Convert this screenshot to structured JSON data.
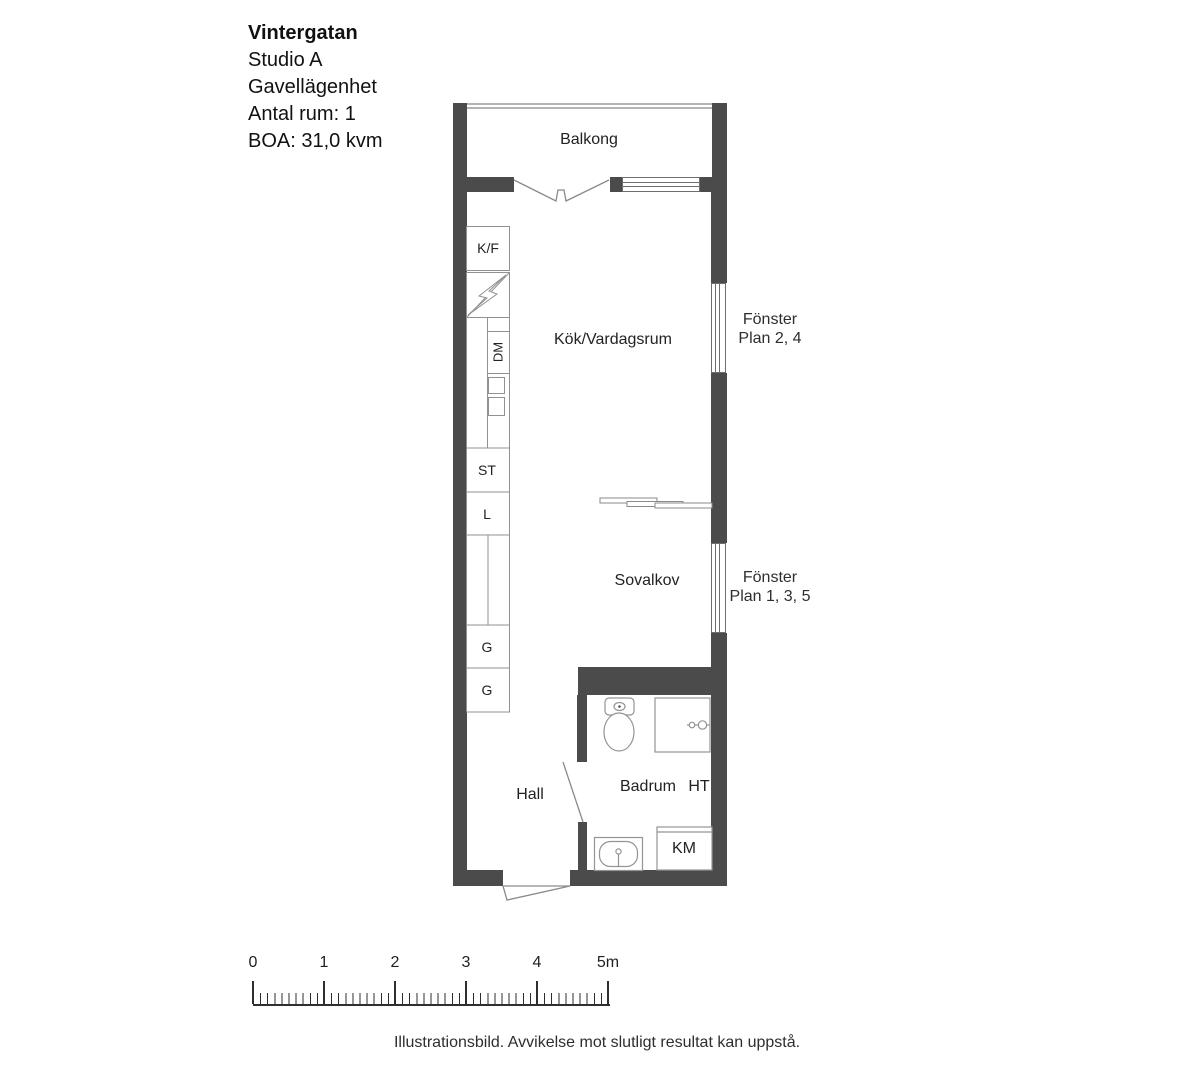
{
  "title": {
    "name": "Vintergatan",
    "lines": [
      "Studio A",
      "Gavellägenhet",
      "Antal rum: 1",
      "BOA: 31,0 kvm"
    ]
  },
  "rooms": {
    "balcony": "Balkong",
    "kitchen_living": "Kök/Vardagsrum",
    "sleeping_alcove": "Sovalkov",
    "hall": "Hall",
    "bathroom": "Badrum"
  },
  "fixtures": {
    "fridge_freezer": "K/F",
    "dishwasher": "DM",
    "cleaning_cabinet": "ST",
    "linen_cabinet": "L",
    "wardrobe_upper": "G",
    "wardrobe_lower": "G",
    "towel_dryer": "HT",
    "washer": "KM"
  },
  "annotations": {
    "window_upper": {
      "line1": "Fönster",
      "line2": "Plan 2, 4"
    },
    "window_lower": {
      "line1": "Fönster",
      "line2": "Plan 1, 3, 5"
    }
  },
  "scale_bar": {
    "labels": [
      "0",
      "1",
      "2",
      "3",
      "4",
      "5m"
    ]
  },
  "footer": {
    "text": "Illustrationsbild. Avvikelse mot slutligt resultat kan uppstå."
  },
  "colors": {
    "wall": "#4b4b4b",
    "fixture_line": "#919191",
    "door_line": "#8a8a8a",
    "text": "#1f1f1f"
  }
}
